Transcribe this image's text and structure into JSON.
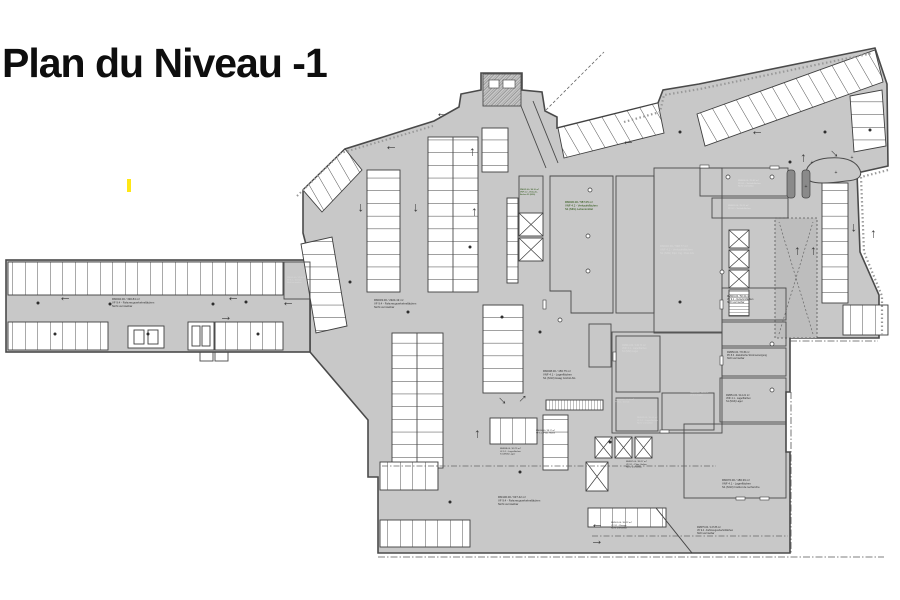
{
  "page": {
    "title": "Plan du Niveau -1"
  },
  "colors": {
    "floor": "#c8c8c8",
    "wall": "#4a4a4a",
    "stall": "#ffffff",
    "green": "#76c11f",
    "blue": "#4675c8",
    "orange": "#f3b184",
    "dark": "#606060",
    "dark_deep": "#4f4f4f",
    "dark_room": "#424242",
    "medium": "#b9b9b9",
    "yellow": "#ffe715",
    "title": "#0e0e0e",
    "arrow": "#3a3a3a"
  },
  "plan": {
    "arrow_glyph": "→",
    "arrow_color": "#3a3a3a",
    "labels": [
      {
        "x": 112,
        "y": 300,
        "c": "#2e2e2e",
        "lines": [
          "RM002.00 / 390.84 m²",
          "VF 9.4 - Fahrzeugverkehrsflächen",
          "Nicht vermietbar"
        ]
      },
      {
        "x": 374,
        "y": 301,
        "c": "#2e2e2e",
        "lines": [
          "RM003.00 / 2924.19 m²",
          "VF 9.4 - Fahrzeugverkehrsflächen",
          "Nicht vermietbar"
        ]
      },
      {
        "x": 565,
        "y": 203,
        "c": "#1c4a00",
        "lines": [
          "RM030.00 / 587.05 m²",
          "VNF 4.2 - Verkaufsflächen",
          "S1 (MIG) Lebensmittel"
        ]
      },
      {
        "x": 520,
        "y": 190,
        "c": "#1c4a00",
        "fs": 2,
        "lines": [
          "RM031.00 / 64.10 m²",
          "VNF 4.2 - Verkaufs-",
          "flächen S1 (MIG)"
        ]
      },
      {
        "x": 660,
        "y": 247,
        "c": "#d9d9d9",
        "lines": [
          "RM040.00 / 598.77 m²",
          "VNF 4.2 - Verkaufsflächen",
          "S1 (MSI) Dipl. Ing. Post AG"
        ]
      },
      {
        "x": 543,
        "y": 372,
        "c": "#2e2e2e",
        "lines": [
          "RM008.00 / 156.75 m²",
          "VNF 4.1 - Lagerflächen",
          "S1 (M13) Haag GmbH AG"
        ]
      },
      {
        "x": 622,
        "y": 346,
        "c": "#d9d9d9",
        "fs": 2.4,
        "lines": [
          "RM041.00 / 132.71 m²",
          "VNF 4.1 - Lagerflächen",
          "S1 (MSI) Lager"
        ]
      },
      {
        "x": 637,
        "y": 418,
        "c": "#d9d9d9",
        "fs": 2.2,
        "lines": [
          "RM042.00 / 56.05 m²",
          "LF 5.1 - Lagerflächen",
          "Nicht vermietbar"
        ]
      },
      {
        "x": 738,
        "y": 181,
        "c": "#e0e0e0",
        "fs": 2.2,
        "lines": [
          "RM060.00 / 25.82 m²",
          "PF 8.1 - Technikflächen",
          "Nicht vermietbar"
        ]
      },
      {
        "x": 728,
        "y": 206,
        "c": "#e0e0e0",
        "fs": 2.2,
        "lines": [
          "RM061.00 / 24.11 m²",
          "PF 8.2 - Technikflächen"
        ]
      },
      {
        "x": 727,
        "y": 297,
        "c": "#2e2e2e",
        "fs": 2.4,
        "lines": [
          "RM049.00 / 58.34 m²",
          "VF 9.1 - Verkehrsflächen",
          "Nicht vermietbar"
        ]
      },
      {
        "x": 727,
        "y": 353,
        "c": "#2e2e2e",
        "fs": 2.4,
        "lines": [
          "RM050.00 / 78.45 m²",
          "PF 8.3 - Elektrische Stromversorgung",
          "Nicht vermietbar"
        ]
      },
      {
        "x": 726,
        "y": 396,
        "c": "#2e2e2e",
        "fs": 2.4,
        "lines": [
          "RM051.00 / 114.21 m²",
          "VNF 4.1 - Lagerflächen",
          "S1 (M13) Lager"
        ]
      },
      {
        "x": 722,
        "y": 481,
        "c": "#2e2e2e",
        "lines": [
          "RM070.00 / 186.39 m²",
          "VNF 4.1 - Lagerflächen",
          "S1 (M13) Institut de recherche"
        ]
      },
      {
        "x": 498,
        "y": 498,
        "c": "#2e2e2e",
        "lines": [
          "RM100.00 / 637.42 m²",
          "VF 9.4 - Fahrzeugverkehrsflächen",
          "Nicht vermietbar"
        ]
      },
      {
        "x": 697,
        "y": 528,
        "c": "#2e2e2e",
        "fs": 2.4,
        "lines": [
          "RM075.00 / 147.86 m²",
          "VF 9.4 - Fahrzeugverkehrsflächen",
          "Nicht vermietbar"
        ]
      },
      {
        "x": 611,
        "y": 523,
        "c": "#2e2e2e",
        "fs": 2.2,
        "lines": [
          "RM101.00 / 56.22 m²",
          "VF 9.1 - Rampe",
          "Nicht vermietbar"
        ]
      },
      {
        "x": 500,
        "y": 449,
        "c": "#2e2e2e",
        "fs": 2.2,
        "lines": [
          "RM098.00 / 43.75 m²",
          "LF 5.1 - Lagerflächen",
          "S1 (M13) Lager"
        ]
      },
      {
        "x": 626,
        "y": 462,
        "c": "#2e2e2e",
        "fs": 2.2,
        "lines": [
          "RM097.00 / 38.17 m²",
          "VF 9.1 - Platz, Halten",
          "Nicht vermietbar"
        ]
      },
      {
        "x": 287,
        "y": 278,
        "c": "#d9d9d9",
        "fs": 2,
        "lines": [
          "RM001.00 / 12.40 m²",
          "PF 8.1 - Technik",
          "Nicht vermietbar"
        ]
      },
      {
        "x": 690,
        "y": 393,
        "c": "#d9d9d9",
        "fs": 2,
        "lines": [
          "RM043.00 / 18.20 m²",
          "LF 5.1 - Lager"
        ]
      },
      {
        "x": 615,
        "y": 400,
        "c": "#d9d9d9",
        "fs": 2,
        "lines": [
          "RM044.00 / 22.40 m²",
          "PF 8.2 - Technik"
        ]
      },
      {
        "x": 536,
        "y": 431,
        "c": "#2e2e2e",
        "fs": 2,
        "lines": [
          "RM096.00 / 58.17 m²",
          "VF 9.1 - Platz, Halten"
        ]
      }
    ],
    "arrows": [
      [
        65,
        301,
        180
      ],
      [
        233,
        301,
        180
      ],
      [
        226,
        316,
        0
      ],
      [
        288,
        306,
        180
      ],
      [
        442,
        117,
        180
      ],
      [
        391,
        150,
        180
      ],
      [
        470,
        152,
        270
      ],
      [
        363,
        208,
        90
      ],
      [
        418,
        208,
        90
      ],
      [
        472,
        212,
        270
      ],
      [
        628,
        145,
        180
      ],
      [
        757,
        135,
        180
      ],
      [
        836,
        152,
        45
      ],
      [
        801,
        158,
        270
      ],
      [
        856,
        228,
        90
      ],
      [
        871,
        234,
        270
      ],
      [
        795,
        251,
        270
      ],
      [
        811,
        251,
        270
      ],
      [
        475,
        434,
        270
      ],
      [
        504,
        399,
        45
      ],
      [
        521,
        397,
        315
      ],
      [
        597,
        528,
        180
      ],
      [
        597,
        540,
        0
      ]
    ],
    "dots_dark": [
      [
        38,
        303
      ],
      [
        110,
        304
      ],
      [
        213,
        304
      ],
      [
        246,
        302
      ],
      [
        55,
        334
      ],
      [
        148,
        334
      ],
      [
        258,
        334
      ],
      [
        350,
        282
      ],
      [
        408,
        312
      ],
      [
        470,
        247
      ],
      [
        502,
        317
      ],
      [
        540,
        332
      ],
      [
        610,
        442
      ],
      [
        680,
        302
      ],
      [
        790,
        162
      ],
      [
        825,
        132
      ],
      [
        870,
        130
      ],
      [
        450,
        502
      ],
      [
        520,
        472
      ],
      [
        680,
        132
      ]
    ],
    "dots_ring": [
      [
        590,
        190
      ],
      [
        588,
        236
      ],
      [
        588,
        271
      ],
      [
        728,
        177
      ],
      [
        772,
        177
      ],
      [
        722,
        272
      ],
      [
        560,
        320
      ],
      [
        772,
        344
      ],
      [
        772,
        390
      ]
    ],
    "plus_marks": [
      [
        812,
        164
      ],
      [
        836,
        174
      ],
      [
        852,
        159
      ],
      [
        806,
        188
      ]
    ]
  }
}
